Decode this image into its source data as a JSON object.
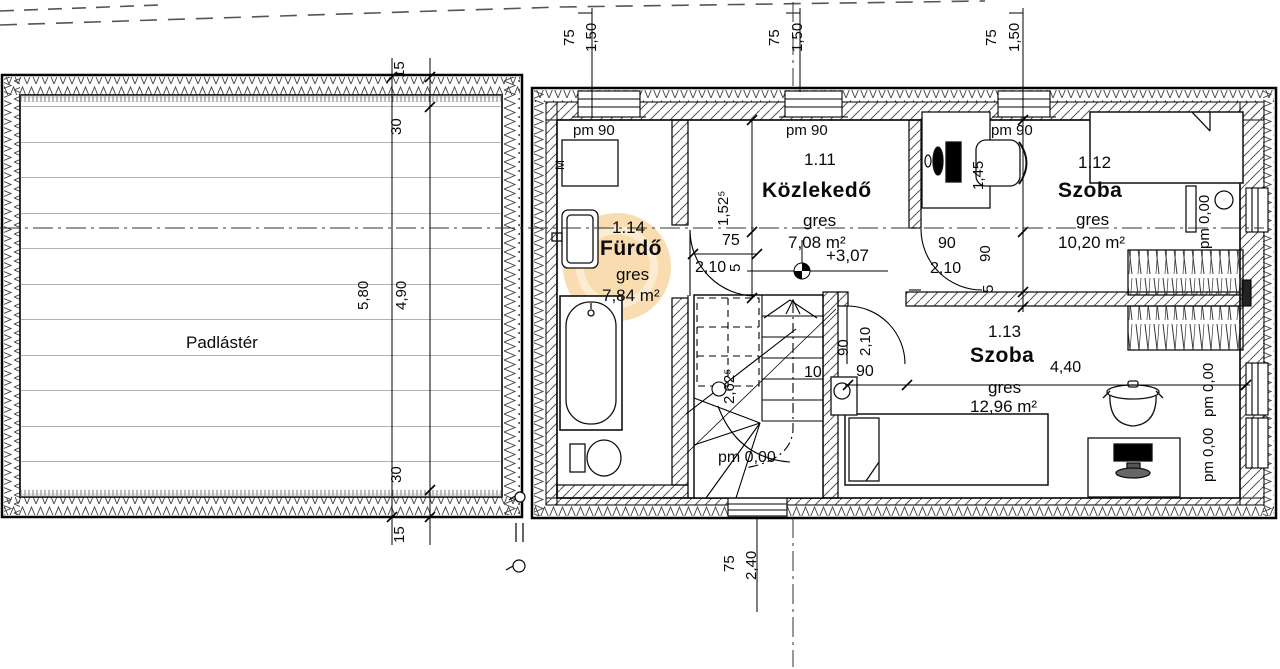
{
  "attic": {
    "label": "Padlástér",
    "dim_total": "5,80",
    "dim_inner": "4,90",
    "dim_top_15": "15",
    "dim_top_30": "30",
    "dim_bot_30": "30",
    "dim_bot_15": "15"
  },
  "axes": {
    "top1_offset": "75",
    "top1_width": "1,50",
    "top2_offset": "75",
    "top2_width": "1,50",
    "top3_offset": "75",
    "top3_width": "1,50",
    "bottom_offset": "75",
    "bottom_width": "2,40"
  },
  "rooms": {
    "r111": {
      "number": "1.11",
      "name": "Közlekedő",
      "floor": "gres",
      "area": "7,08 m²",
      "level": "+3,07",
      "parapet": "pm 90",
      "dim_height": "1,52⁵",
      "door_width": "75",
      "door_gap": "5",
      "door_height": "2,10"
    },
    "r112": {
      "number": "1.12",
      "name": "Szoba",
      "floor": "gres",
      "area": "10,20 m²",
      "parapet": "pm 90",
      "parapet_right": "pm 0,00",
      "door_width": "90",
      "door_height": "2,10",
      "chain_145": "1,45",
      "chain_90": "90",
      "chain_5": "5"
    },
    "r113": {
      "number": "1.13",
      "name": "Szoba",
      "floor": "gres",
      "area": "12,96 m²",
      "dim_width": "4,40",
      "dim_90": "90",
      "dim_10": "10",
      "door_width": "90",
      "door_height": "2,10",
      "parapet_win1": "pm 0,00",
      "parapet_win2": "pm 0,00"
    },
    "r114": {
      "number": "1.14",
      "name": "Fürdő",
      "floor": "gres",
      "area": "7,84 m²",
      "parapet": "pm 90",
      "washer": "M"
    },
    "stairs": {
      "run_length": "2,62⁵",
      "level": "pm 0,00"
    }
  }
}
